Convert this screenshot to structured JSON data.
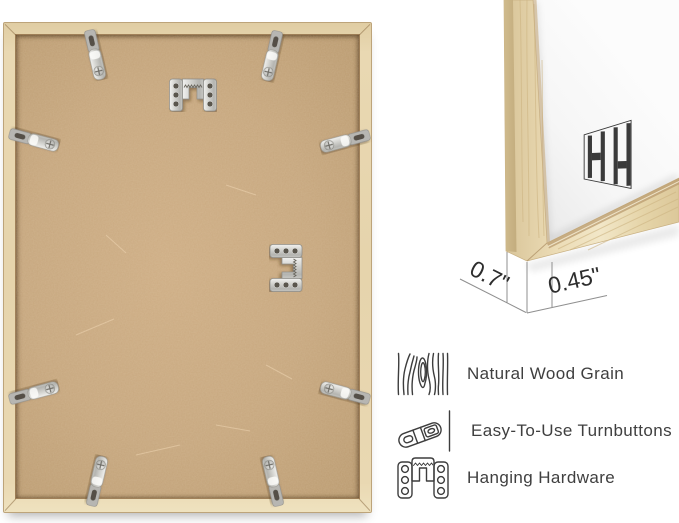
{
  "corner_photo": {
    "logo_name": "hh-brand-mark",
    "dimensions": {
      "depth": "0.7\"",
      "face_width": "0.45\""
    }
  },
  "features": [
    {
      "icon": "wood-grain-icon",
      "label": "Natural Wood Grain"
    },
    {
      "icon": "turnbutton-icon",
      "label": "Easy-To-Use Turnbuttons"
    },
    {
      "icon": "hanging-hardware-icon",
      "label": "Hanging Hardware"
    }
  ],
  "colors": {
    "frame_wood": "#e7d5ae",
    "backboard": "#c7a77e",
    "metal_hardware": "#cfcfcb",
    "feature_text": "#3f3f3f",
    "dimension_text": "#2d2d2d",
    "dimension_line": "#8f8f8f",
    "logo": "#3a3a3a",
    "background": "#ffffff"
  }
}
